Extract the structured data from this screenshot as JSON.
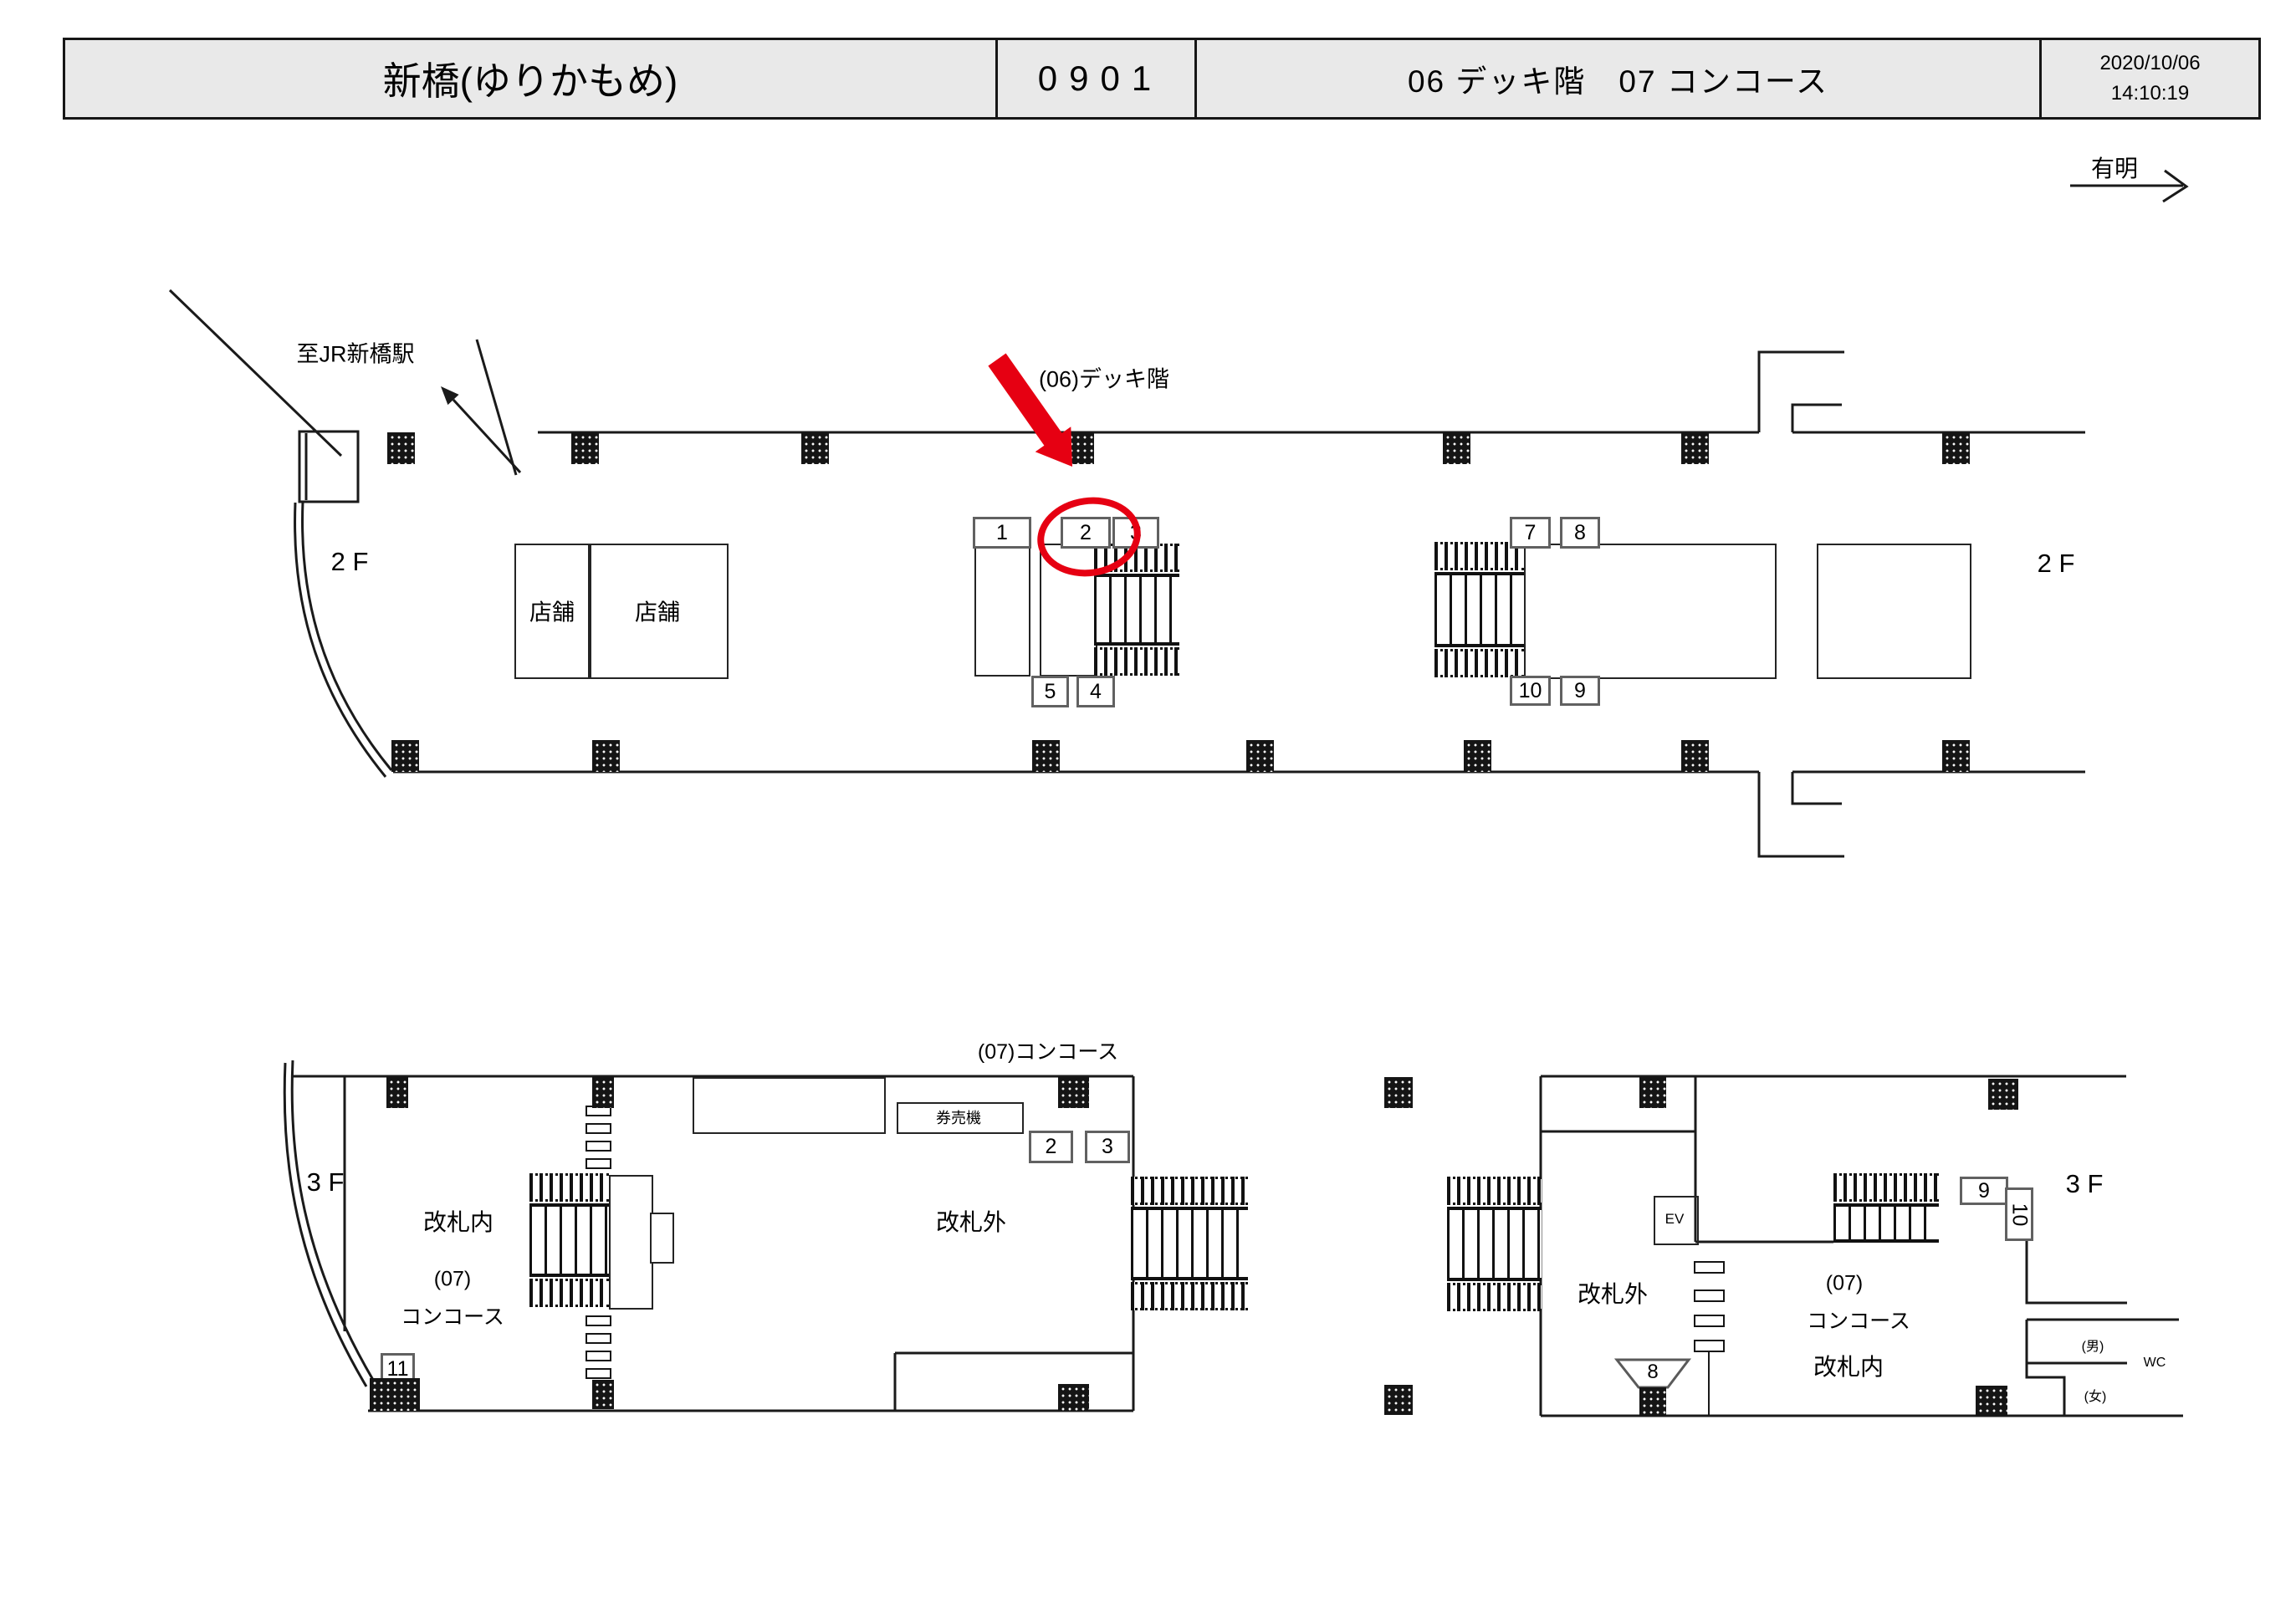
{
  "colors": {
    "accent_red": "#e60012",
    "header_bg": "#e9e9e9",
    "line": "#1a1a1a"
  },
  "header": {
    "station": "新橋(ゆりかもめ)",
    "code": "0901",
    "floors": "06 デッキ階　07 コンコース",
    "date": "2020/10/06",
    "time": "14:10:19"
  },
  "compass": {
    "ariake": "有明",
    "to_jr": "至JR新橋駅"
  },
  "deck": {
    "caption": "(06)デッキ階",
    "floor_left": "2 F",
    "floor_right": "2 F",
    "shop_a": "店舗",
    "shop_b": "店舗",
    "signs": {
      "s1": "1",
      "s2": "2",
      "s3": "3",
      "s4": "4",
      "s5": "5",
      "s7": "7",
      "s8": "8",
      "s9": "9",
      "s10": "10"
    }
  },
  "concourse_left": {
    "caption": "(07)コンコース",
    "floor": "3 F",
    "inside_gate": "改札内",
    "code": "(07)",
    "concourse": "コンコース",
    "outside_gate": "改札外",
    "ticket_machine": "券売機",
    "signs": {
      "s2": "2",
      "s3": "3",
      "s11": "11"
    }
  },
  "concourse_right": {
    "floor": "3 F",
    "elevator": "EV",
    "outside_gate": "改札外",
    "code": "(07)",
    "concourse": "コンコース",
    "inside_gate": "改札内",
    "toilet": "WC",
    "men": "(男)",
    "women": "(女)",
    "signs": {
      "s8": "8",
      "s9": "9",
      "s10": "10"
    }
  }
}
